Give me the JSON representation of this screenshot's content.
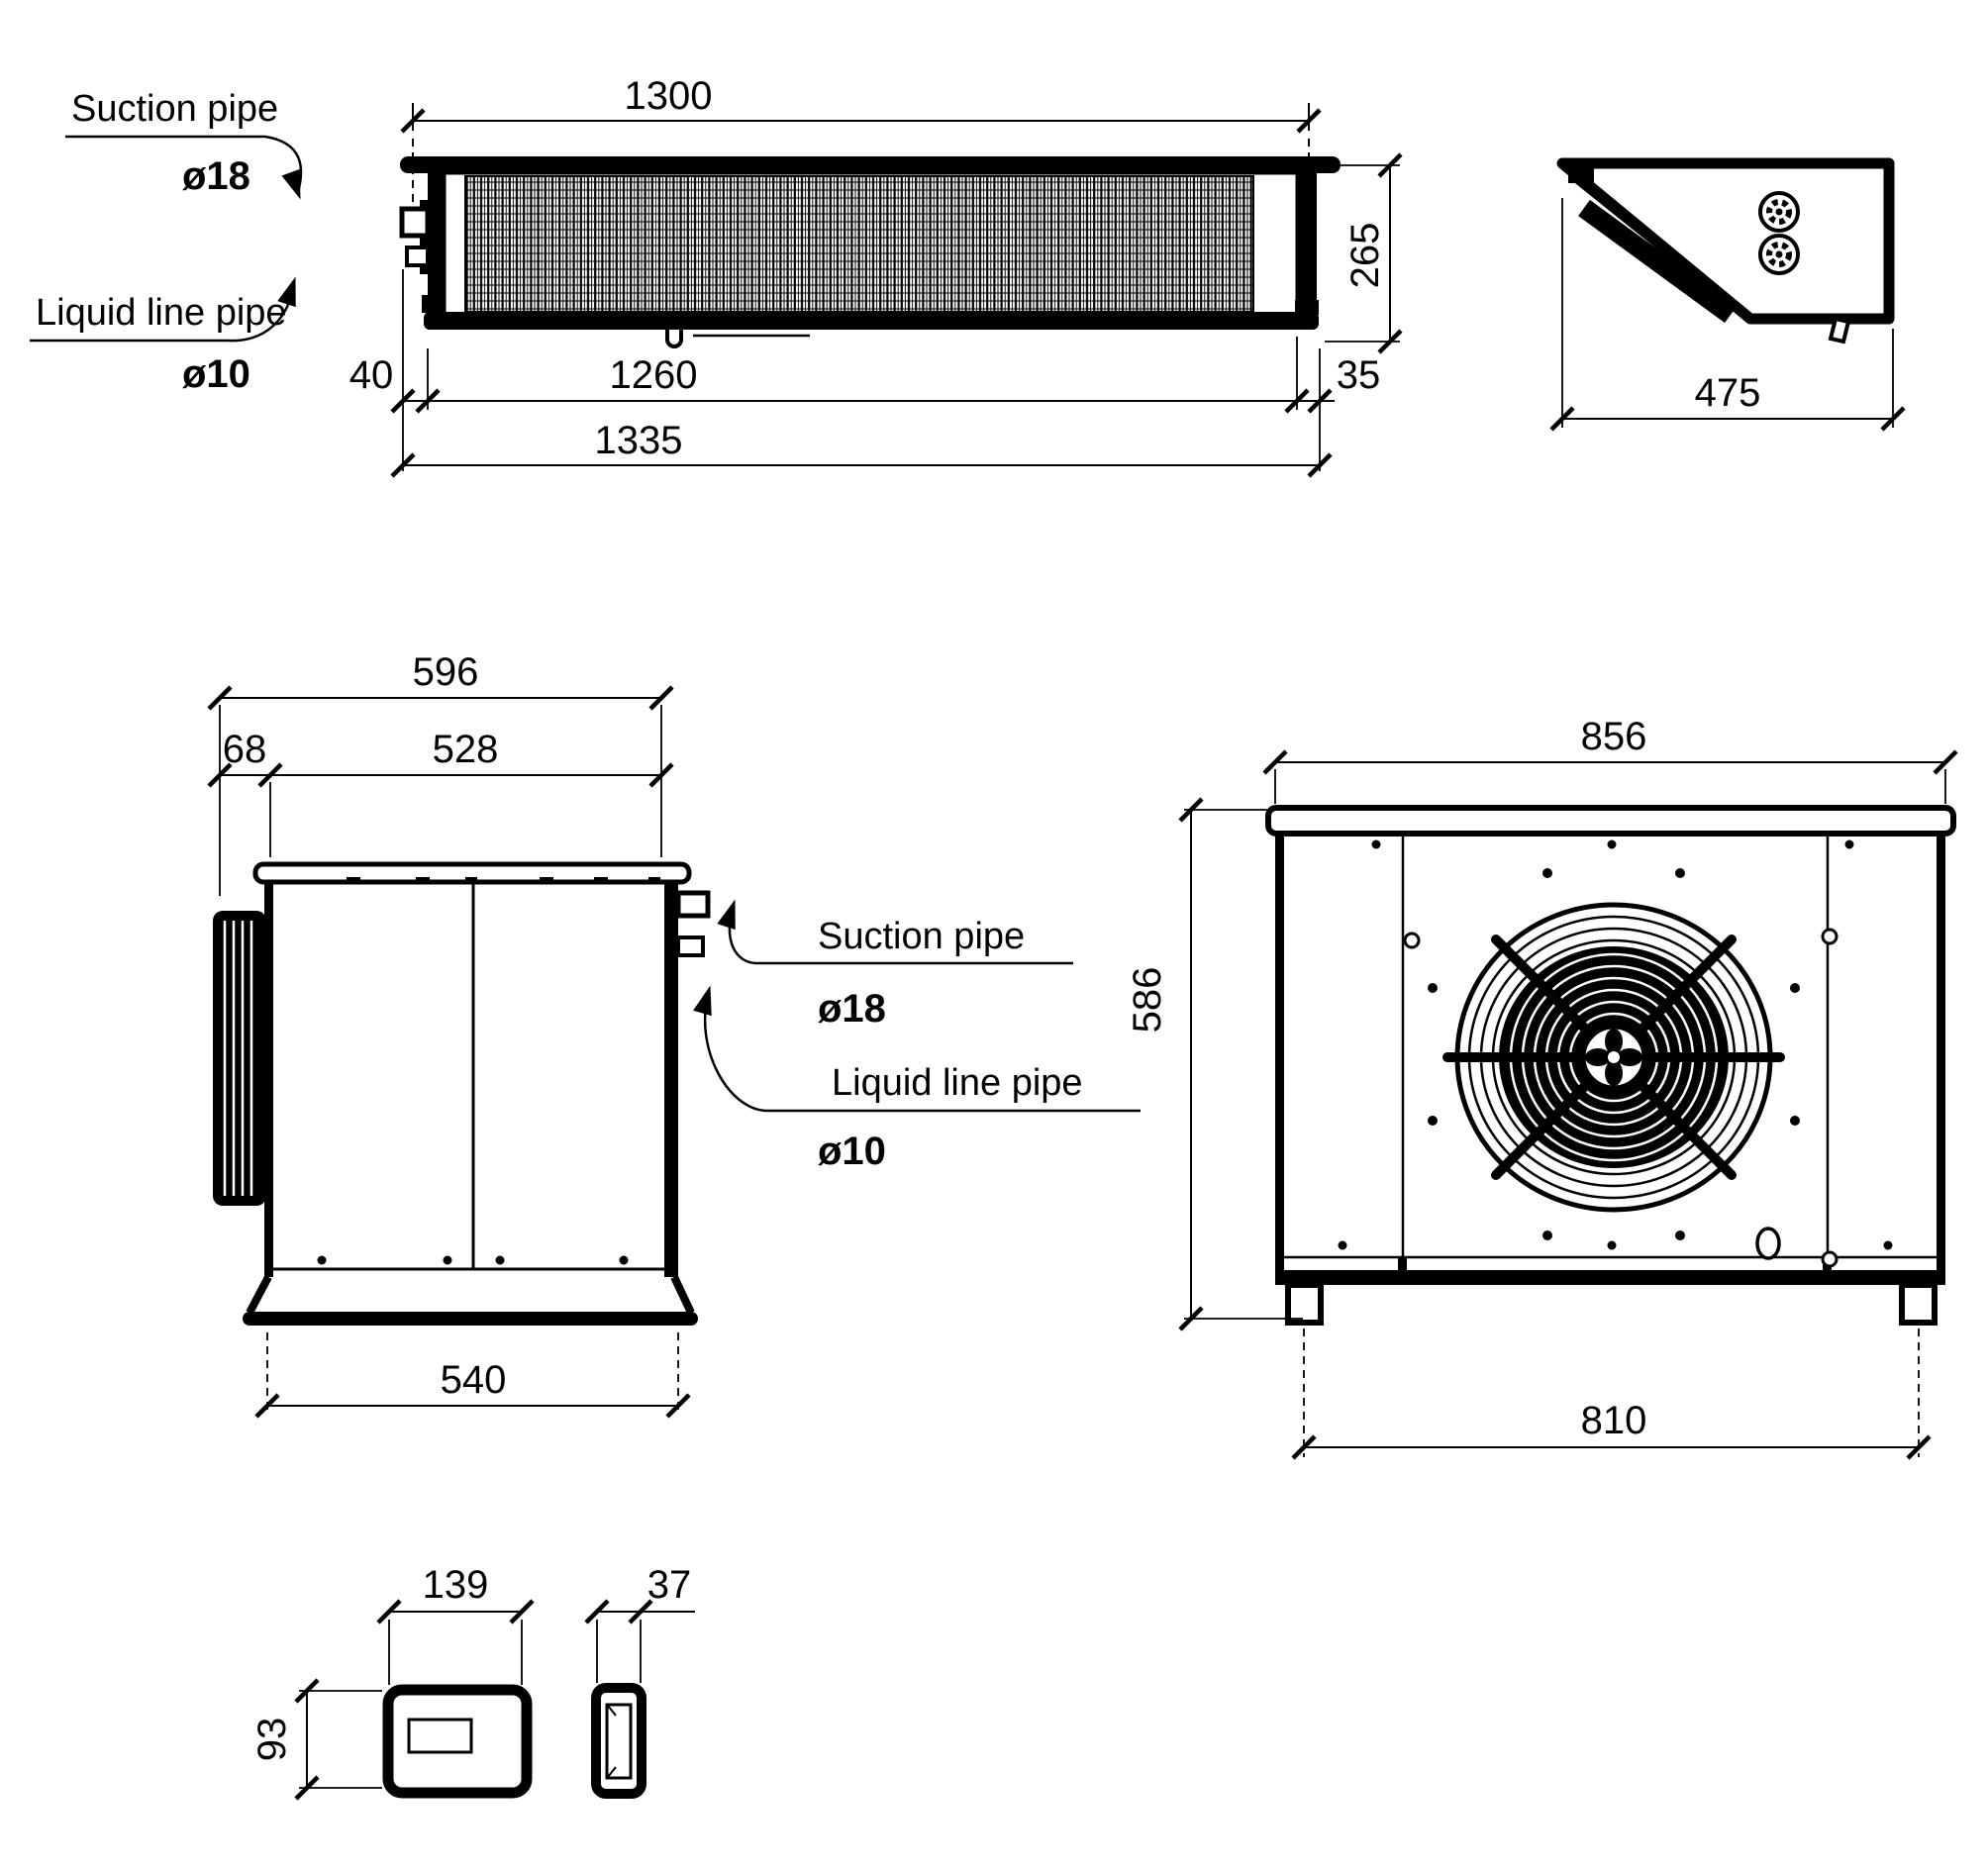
{
  "drawing": {
    "labels": {
      "suction_pipe": "Suction pipe",
      "suction_dia": "ø18",
      "liquid_pipe": "Liquid line pipe",
      "liquid_dia": "ø10"
    },
    "evaporator": {
      "top_view": {
        "overall_length": "1300",
        "height": "265",
        "pipe_offset": "40",
        "mounting_length": "1260",
        "end_offset": "35",
        "total_length": "1335"
      },
      "side_view": {
        "depth": "475"
      }
    },
    "condensing_unit": {
      "side_view": {
        "overall_depth": "596",
        "coil_depth": "68",
        "body_depth": "528",
        "base_depth": "540"
      },
      "front_view": {
        "width": "856",
        "height": "586",
        "feet_spacing": "810"
      }
    },
    "controller": {
      "width": "139",
      "height": "93",
      "depth": "37"
    },
    "colors": {
      "line": "#000000",
      "background": "#ffffff"
    }
  }
}
